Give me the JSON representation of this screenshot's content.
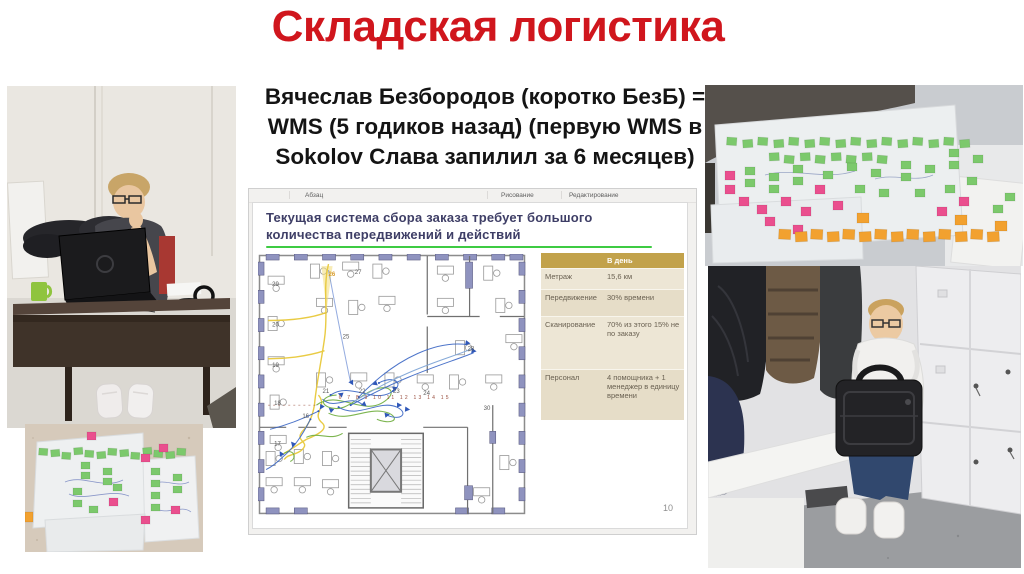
{
  "slide": {
    "title": "Складская логистика",
    "subtitle_lines": [
      "Вячеслав Безбородов (коротко БезБ) =",
      "WMS (5 годиков назад) (первую WMS в",
      "Sokolov Слава запилил за 6 месяцев)"
    ],
    "colors": {
      "title": "#d0161d",
      "body_text": "#141414"
    }
  },
  "embedded_screenshot": {
    "toolbar_groups": [
      "Абзац",
      "Рисование",
      "Редактирование"
    ],
    "slide_title_lines": [
      "Текущая система сбора заказа требует большого",
      "количества передвижений и действий"
    ],
    "page_number": "10",
    "colors": {
      "slide_title": "#3e3e66",
      "underline": "#3ecb43",
      "table_header_bg": "#c2a24b",
      "wall_accent": "#8f93bf",
      "path_yellow": "#e8c93b",
      "path_blue": "#3a66c4",
      "path_green": "#6fae3e"
    },
    "table": {
      "header": [
        "",
        "В день"
      ],
      "rows": [
        {
          "label": "Метраж",
          "value": "15,6 км"
        },
        {
          "label": "Передвижение",
          "value": "30% времени"
        },
        {
          "label": "Сканирование",
          "value": "70% из этого 15% не по заказу"
        },
        {
          "label": "Персонал",
          "value": "4 помощника + 1 менеджер в единицу времени"
        }
      ]
    },
    "floor_plan": {
      "room_numbers": [
        {
          "n": "29",
          "x": 14,
          "y": 32
        },
        {
          "n": "20",
          "x": 14,
          "y": 72
        },
        {
          "n": "19",
          "x": 14,
          "y": 112
        },
        {
          "n": "18",
          "x": 16,
          "y": 150
        },
        {
          "n": "17",
          "x": 16,
          "y": 190
        },
        {
          "n": "26",
          "x": 70,
          "y": 22
        },
        {
          "n": "27",
          "x": 96,
          "y": 20
        },
        {
          "n": "25",
          "x": 84,
          "y": 84
        },
        {
          "n": "21",
          "x": 64,
          "y": 138
        },
        {
          "n": "22",
          "x": 100,
          "y": 138
        },
        {
          "n": "23",
          "x": 134,
          "y": 138
        },
        {
          "n": "24",
          "x": 164,
          "y": 140
        },
        {
          "n": "28",
          "x": 208,
          "y": 96
        },
        {
          "n": "16",
          "x": 44,
          "y": 163
        },
        {
          "n": "30",
          "x": 224,
          "y": 155
        }
      ],
      "corridor_numbers": "6 7 8 9 10 11 12 13 14 15"
    }
  }
}
